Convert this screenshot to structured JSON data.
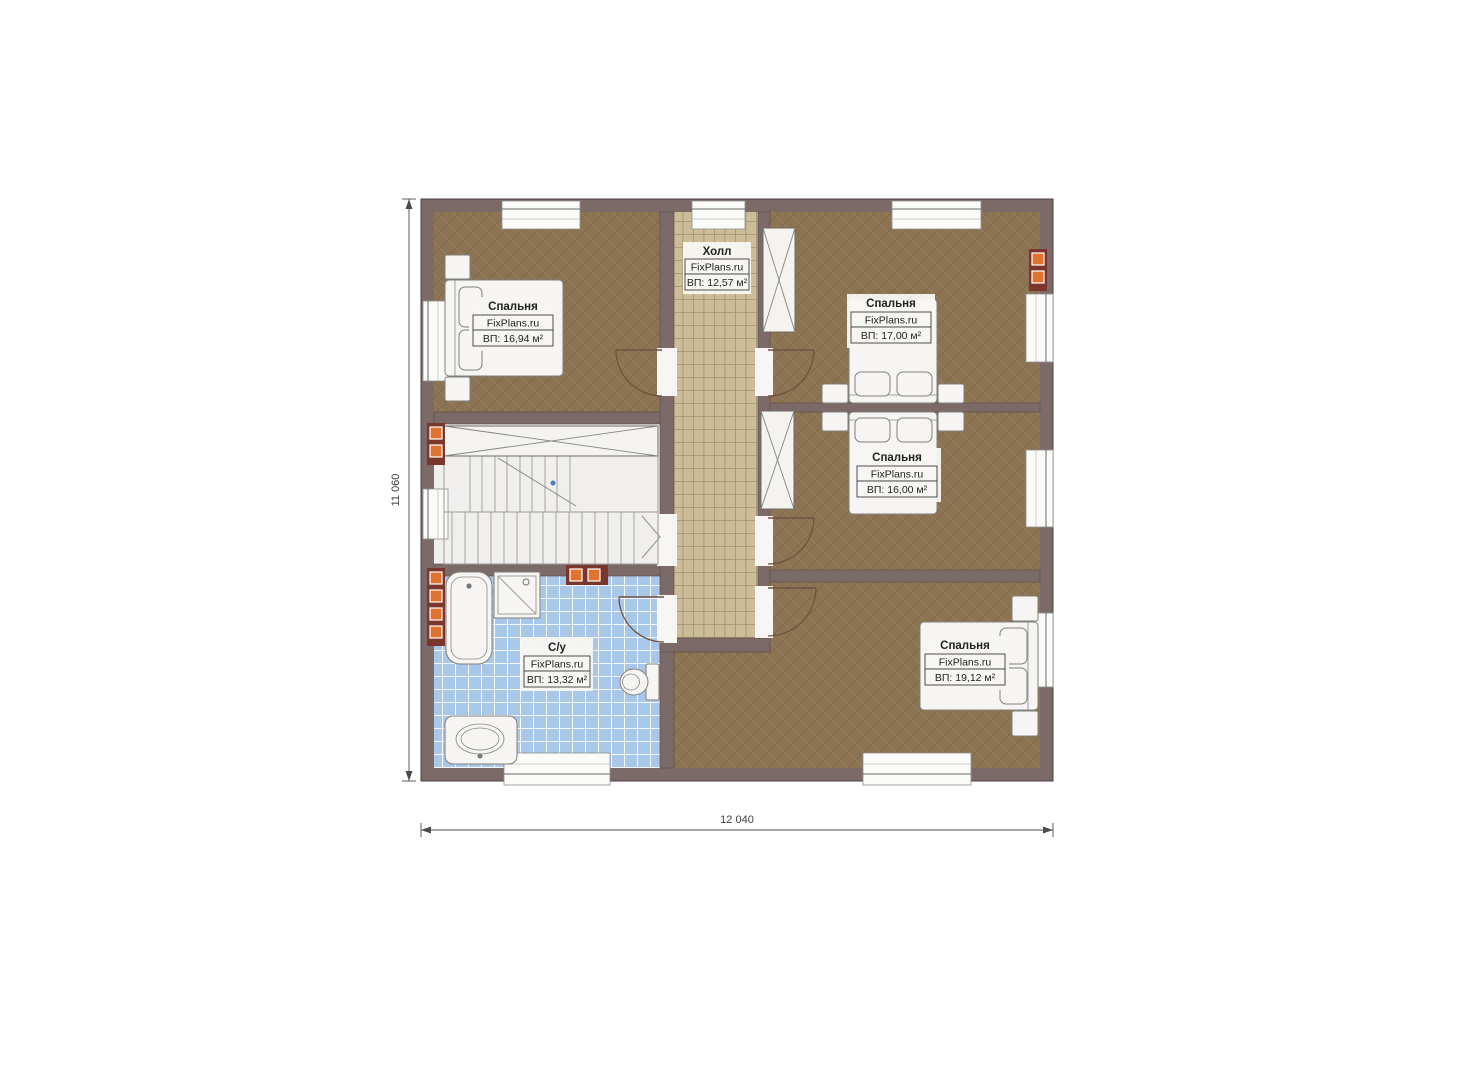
{
  "brand": "FixPlans.ru",
  "dimensions": {
    "width": "12 040",
    "height": "11 060"
  },
  "rooms": [
    {
      "key": "bedroom_top_left",
      "name": "Спальня",
      "brand": "FixPlans.ru",
      "area": "ВП: 16,94 м²"
    },
    {
      "key": "hall",
      "name": "Холл",
      "brand": "FixPlans.ru",
      "area": "ВП: 12,57 м²"
    },
    {
      "key": "bedroom_top_right",
      "name": "Спальня",
      "brand": "FixPlans.ru",
      "area": "ВП: 17,00 м²"
    },
    {
      "key": "bedroom_middle_right",
      "name": "Спальня",
      "brand": "FixPlans.ru",
      "area": "ВП: 16,00 м²"
    },
    {
      "key": "bathroom",
      "name": "С/у",
      "brand": "FixPlans.ru",
      "area": "ВП: 13,32 м²"
    },
    {
      "key": "bedroom_bottom_right",
      "name": "Спальня",
      "brand": "FixPlans.ru",
      "area": "ВП: 19,12 м²"
    }
  ],
  "colors": {
    "wall": "#7c6a68",
    "bedroom_floor": "#8c7453",
    "hall_floor": "#ccbc97",
    "bath_floor": "#a9c7e9",
    "stairs_floor": "#f0efed",
    "radiator": "#e0742e",
    "radiator_frame": "#7c352a"
  }
}
